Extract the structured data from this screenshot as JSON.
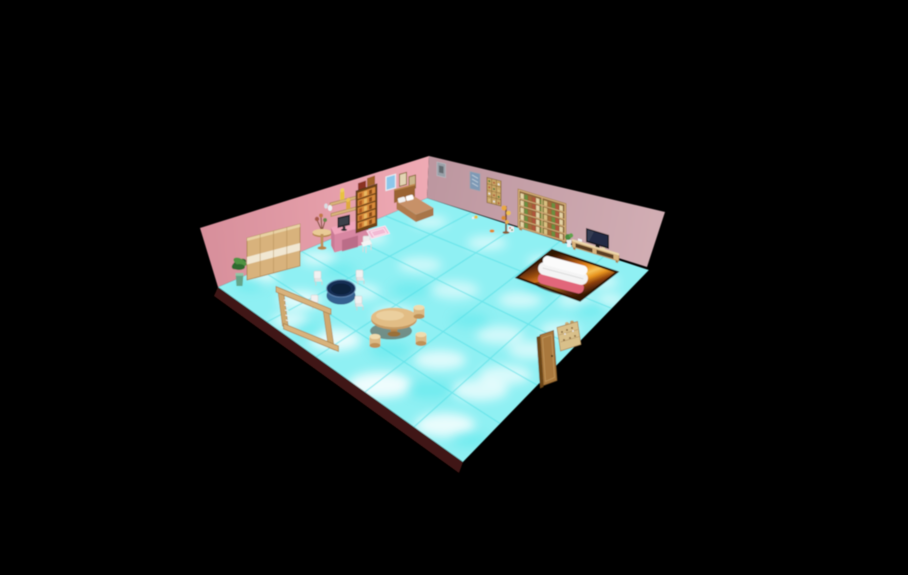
{
  "scene": {
    "description": "3D rendered dollhouse-style bedroom viewed from an elevated corner angle on a black void background",
    "view": "isometric-perspective room render",
    "background_color": "#000000"
  },
  "palette": {
    "bg": "#000000",
    "wallLa": "#d78f9b",
    "wallLb": "#efaab4",
    "wallRa": "#bd97a0",
    "wallRb": "#d2aeb4",
    "floorBase": "#8ff0f3",
    "floorDeep": "#57e6ec",
    "floorLine": "#4edce4",
    "floorEdge": "#3f1512",
    "wood": "#d8b27c",
    "woodLight": "#ecd7ab",
    "woodDark": "#a9824d",
    "woodDeep": "#6e4218",
    "shelfOrange": "#d98a3a",
    "cream": "#f1e7d2",
    "leaf": "#2f6b2f",
    "leafLight": "#4f9343",
    "pot": "#63a488",
    "pinkDesk": "#f0a4ba",
    "pinkDeskDark": "#d887a2",
    "pinkDeskSide": "#c97a95",
    "monitor": "#26262b",
    "posterBlue": "#8cc7ea",
    "bedFrame": "#9a6432",
    "bedBlanket": "#c79167",
    "bedFront": "#a8744a",
    "pillow": "#f2f2f2",
    "rugPink": "#f2bad4",
    "picGray": "#99a0a8",
    "picBlue": "#7e99b5",
    "boxTan": "#c9a565",
    "rugDark": "#401c05",
    "rugOrange": "#e2861a",
    "rugGold": "#f6bd55",
    "sofaWhite": "#f4f4f4",
    "sofaPink": "#e2667a",
    "tblBlueTop": "#142f55",
    "tblBlueSide": "#35608f",
    "chairWhite": "#ededed",
    "stool": "#e3c48e",
    "tableTop": "#e2bd85",
    "tvDark": "#17171d",
    "tvScreen": "#232c45",
    "bookGreen": "#6b8f3f",
    "bookRed": "#b0543a",
    "bookCream": "#e4d3a4",
    "bookBrown": "#a56a38",
    "doorBrown": "#a9783c",
    "doorDark": "#6b4418",
    "toyYellow": "#e8c23f"
  },
  "room": {
    "left_wall_color": "#e7a1ab",
    "right_wall_color": "#c8a3aa",
    "floor_style": "cyan marble tiles, 5x5 grid",
    "floor_edge_color": "#3f1512"
  },
  "furniture": [
    {
      "name": "wardrobe",
      "color": "#d8b27c",
      "location": "left wall"
    },
    {
      "name": "potted-plant",
      "color": "#2f6b2f",
      "location": "left wall corner"
    },
    {
      "name": "side-table-with-dried-plant",
      "color": "#e3c08c",
      "location": "left wall"
    },
    {
      "name": "wall-shelves-with-figurines",
      "color": "#dcb77e",
      "location": "left wall"
    },
    {
      "name": "computer-desk",
      "color": "#f0a4ba",
      "location": "left wall"
    },
    {
      "name": "monitor",
      "color": "#26262b",
      "location": "on desk"
    },
    {
      "name": "desk-chair",
      "color": "#ededed",
      "location": "at desk"
    },
    {
      "name": "tall-shelf",
      "color": "#6e4218",
      "location": "left wall"
    },
    {
      "name": "blue-poster",
      "color": "#8cc7ea",
      "location": "left wall"
    },
    {
      "name": "picture-frame",
      "color": "#c9a86a",
      "count": 2,
      "location": "above bed"
    },
    {
      "name": "bed",
      "color": "#c79167",
      "location": "left wall"
    },
    {
      "name": "pink-rug",
      "color": "#f2bad4",
      "location": "beside bed"
    },
    {
      "name": "gray-picture",
      "color": "#99a0a8",
      "location": "right wall"
    },
    {
      "name": "blue-picture",
      "color": "#7e99b5",
      "location": "right wall"
    },
    {
      "name": "display-cabinet",
      "color": "#c9a565",
      "location": "right wall"
    },
    {
      "name": "flower-stand",
      "color": "#e8a83f",
      "location": "right wall"
    },
    {
      "name": "bookcase",
      "color": "#dcb77e",
      "location": "right wall"
    },
    {
      "name": "tv",
      "color": "#17171d",
      "location": "right wall"
    },
    {
      "name": "tv-console",
      "color": "#d8b27c",
      "location": "right wall"
    },
    {
      "name": "console-plant",
      "color": "#4a8a3f",
      "location": "beside console"
    },
    {
      "name": "orange-rug",
      "color": "#e2861a",
      "location": "right floor"
    },
    {
      "name": "sofa",
      "color": "#f4f4f4",
      "base_color": "#e2667a",
      "location": "on orange rug"
    },
    {
      "name": "blue-table",
      "color": "#142f55",
      "location": "center-left floor"
    },
    {
      "name": "white-chair",
      "color": "#ededed",
      "count": 4,
      "location": "around blue table"
    },
    {
      "name": "round-table",
      "color": "#e2bd85",
      "location": "center floor"
    },
    {
      "name": "stool",
      "color": "#e3c48e",
      "count": 3,
      "location": "around round table"
    },
    {
      "name": "wooden-frame-rack",
      "color": "#d8b27c",
      "location": "front-left floor"
    },
    {
      "name": "door",
      "color": "#a9783c",
      "location": "front-right edge"
    },
    {
      "name": "door-side-shelf",
      "color": "#d9c08a",
      "location": "front-right edge"
    }
  ]
}
